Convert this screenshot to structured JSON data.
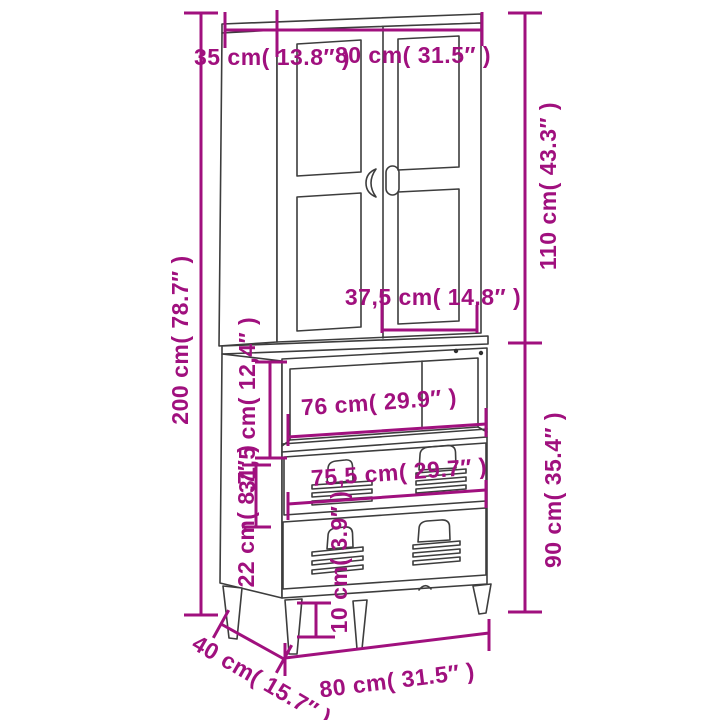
{
  "diagram": {
    "type": "furniture-dimension-diagram",
    "subject": "highboard with two glass doors, open compartment, two locker-style drawers and tapered legs",
    "background_color": "#FFFFFF",
    "furniture_line_color": "#3D3D3D",
    "dimension_color": "#A0107E",
    "dims": {
      "cabinet_depth_top": {
        "label": "35 cm( 13.8″ )",
        "cm": "35",
        "inch": "13.8"
      },
      "cabinet_width_top": {
        "label": "80 cm( 31.5″ )",
        "cm": "80",
        "inch": "31.5"
      },
      "upper_section_height": {
        "label": "110 cm( 43.3″ )",
        "cm": "110",
        "inch": "43.3"
      },
      "total_height": {
        "label": "200 cm( 78.7″ )",
        "cm": "200",
        "inch": "78.7"
      },
      "door_width": {
        "label": "37,5 cm( 14.8″ )",
        "cm": "37,5",
        "inch": "14.8"
      },
      "compartment_height": {
        "label": "31,5 cm( 12,4″ )",
        "cm": "31,5",
        "inch": "12,4"
      },
      "compartment_width": {
        "label": "76 cm( 29.9″ )",
        "cm": "76",
        "inch": "29.9"
      },
      "drawer_front_height": {
        "label": "22 cm( 8.7″ )",
        "cm": "22",
        "inch": "8.7"
      },
      "drawer_width": {
        "label": "75,5 cm( 29.7″ )",
        "cm": "75,5",
        "inch": "29.7"
      },
      "lower_section_height": {
        "label": "90 cm( 35.4″ )",
        "cm": "90",
        "inch": "35.4"
      },
      "leg_height": {
        "label": "10 cm( 3.9″ )",
        "cm": "10",
        "inch": "3.9"
      },
      "cabinet_width_bottom": {
        "label": "80 cm( 31.5″ )",
        "cm": "80",
        "inch": "31.5"
      },
      "cabinet_depth_bottom": {
        "label": "40 cm( 15.7″ )",
        "cm": "40",
        "inch": "15.7"
      }
    }
  }
}
